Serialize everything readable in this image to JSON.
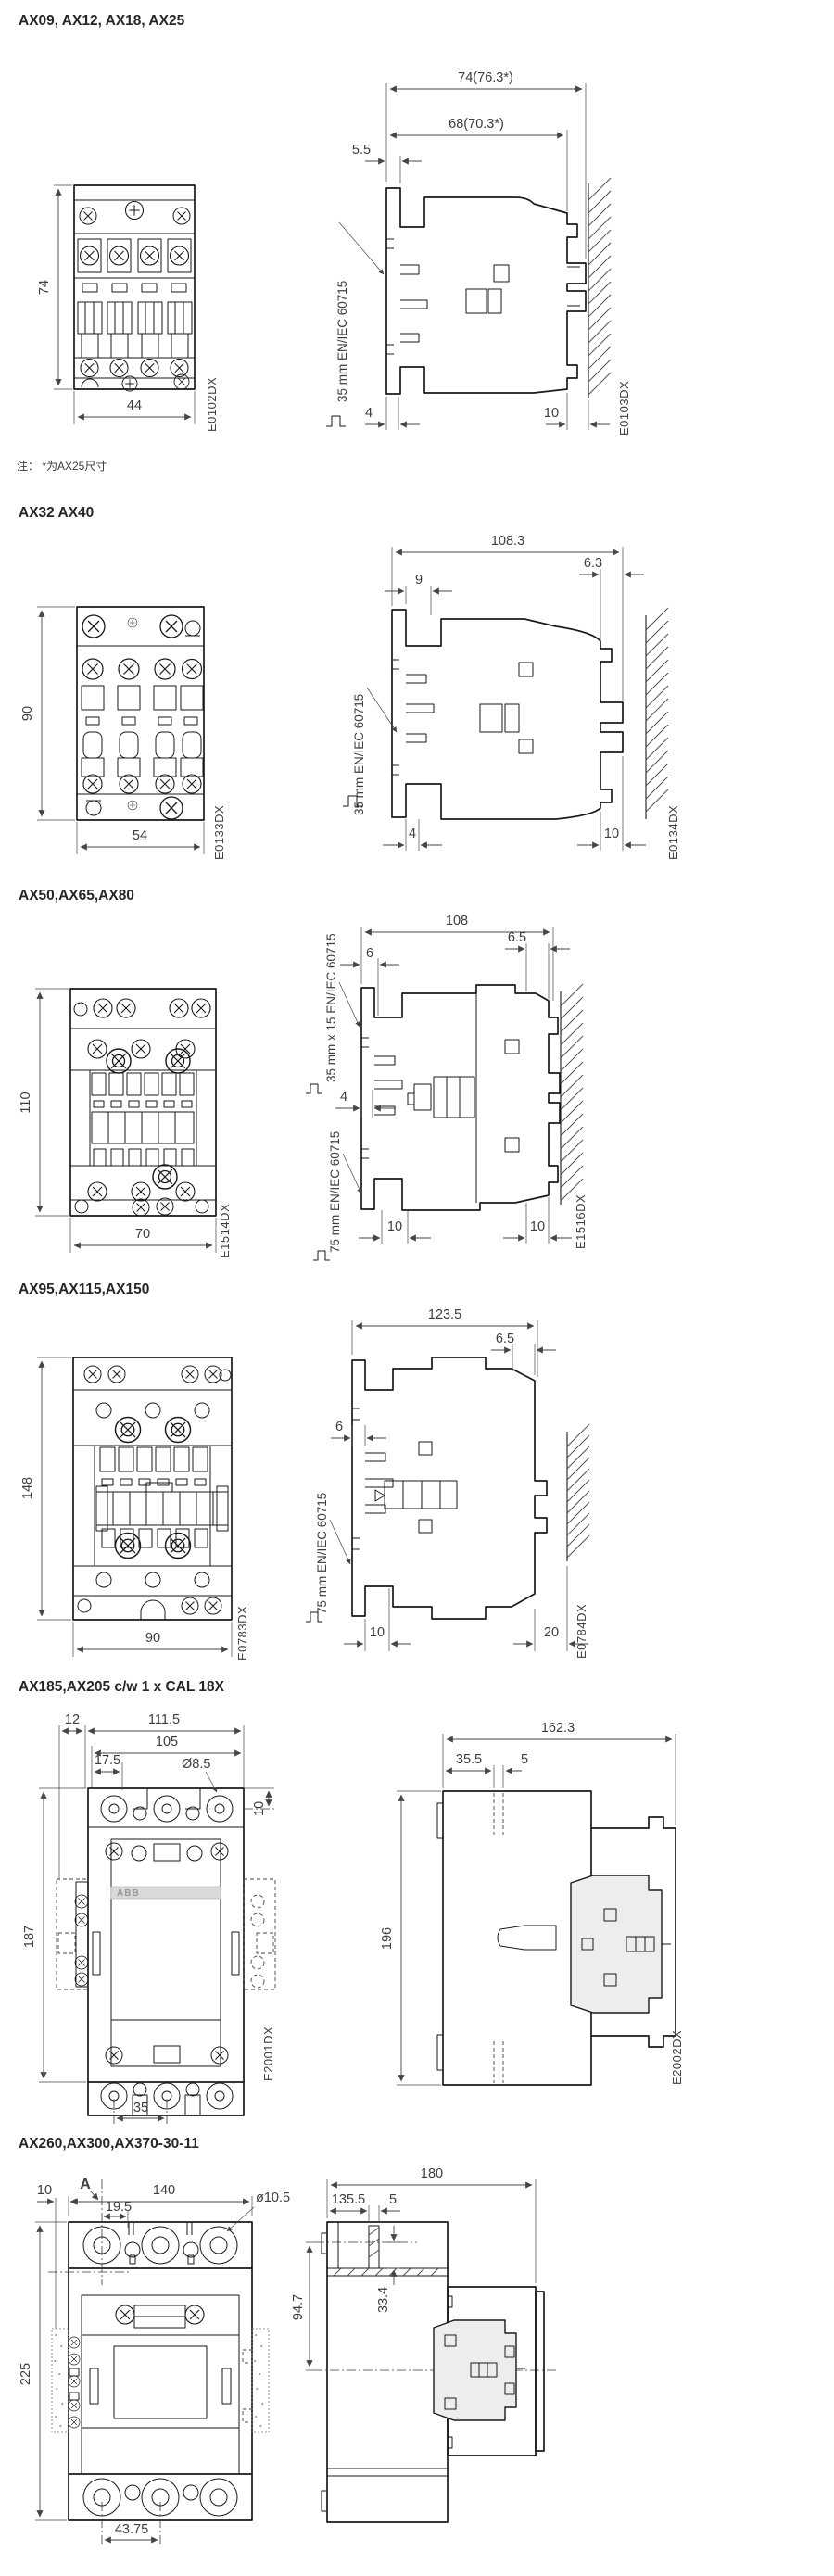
{
  "page": {
    "background": "#ffffff",
    "line_color": "#1a1a1a",
    "dim_color": "#3d3d3d"
  },
  "sections": [
    {
      "title": "AX09, AX12, AX18, AX25",
      "note": "注： *为AX25尺寸",
      "front": {
        "height": "74",
        "width": "44",
        "code": "E0102DX"
      },
      "side": {
        "top1": "74(76.3*)",
        "top2": "68(70.3*)",
        "left1": "5.5",
        "bot1": "4",
        "bot2": "10",
        "rail1": "35 mm EN/IEC 60715",
        "code": "E0103DX"
      }
    },
    {
      "title": "AX32 AX40",
      "front": {
        "height": "90",
        "width": "54",
        "code": "E0133DX"
      },
      "side": {
        "top1": "108.3",
        "left1": "9",
        "right1": "6.3",
        "bot1": "4",
        "bot2": "10",
        "rail1": "35 mm EN/IEC 60715",
        "code": "E0134DX"
      }
    },
    {
      "title": "AX50,AX65,AX80",
      "front": {
        "height": "110",
        "width": "70",
        "code": "E1514DX"
      },
      "side": {
        "top1": "108",
        "left1": "6",
        "right1": "6.5",
        "mid1": "4",
        "bot1": "10",
        "bot2": "10",
        "rail1": "35 mm x 15 EN/IEC 60715",
        "rail2": "75 mm EN/IEC 60715",
        "code": "E1516DX"
      }
    },
    {
      "title": "AX95,AX115,AX150",
      "front": {
        "height": "148",
        "width": "90",
        "code": "E0783DX"
      },
      "side": {
        "top1": "123.5",
        "left1": "6",
        "right1": "6.5",
        "bot1": "10",
        "bot2": "20",
        "rail1": "75 mm EN/IEC 60715",
        "code": "E0784DX"
      }
    },
    {
      "title": "AX185,AX205 c/w 1 x CAL 18X",
      "front": {
        "d12": "12",
        "d111": "111.5",
        "d105": "105",
        "d175": "17.5",
        "dia": "Ø8.5",
        "d10": "10",
        "height": "187",
        "d35": "35",
        "code": "E2001DX",
        "logo": "ABB"
      },
      "side": {
        "top1": "162.3",
        "d355": "35.5",
        "d5": "5",
        "height": "196",
        "code": "E2002DX"
      }
    },
    {
      "title": "AX260,AX300,AX370-30-11",
      "front": {
        "marker": "A",
        "d10": "10",
        "d140": "140",
        "d195": "19.5",
        "dia": "ø10.5",
        "height": "225",
        "d4375": "43.75"
      },
      "side": {
        "top1": "180",
        "d1355": "135.5",
        "d5": "5",
        "d947": "94.7",
        "d334": "33.4"
      }
    }
  ]
}
